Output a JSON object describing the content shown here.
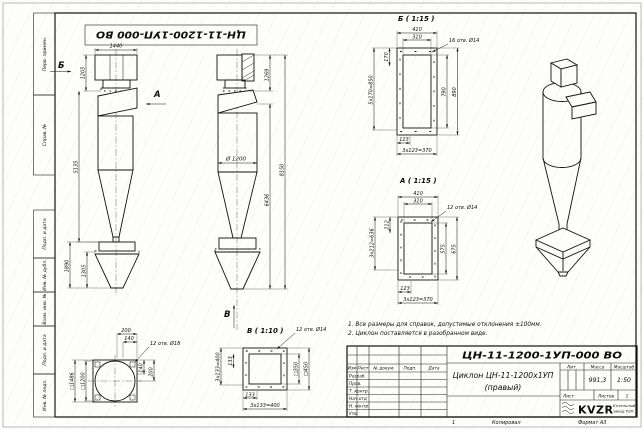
{
  "sheet": {
    "stamp_number": "ЦН-11-1200-1УП-000 ВО",
    "copied_label": "Копировал",
    "format_label": "Формат А3",
    "small_one": "1"
  },
  "frame_labels": [
    "Перв. примен.",
    "Справ. №",
    "Подп. и дата",
    "Инв. № дубл.",
    "Взам. инв. №",
    "Подп. и дата",
    "Инв. № подл."
  ],
  "notes": {
    "line1": "1. Все размеры для справок, допустимые отклонения ±100мм.",
    "line2": "2. Циклон поставляется в разобранном виде."
  },
  "front_view": {
    "label_b": "Б",
    "label_a": "А",
    "dim_1440": "1440",
    "dim_1205": "1205",
    "dim_5135": "5135",
    "dim_1890": "1890",
    "dim_1305": "1305"
  },
  "side_view": {
    "label_v": "В",
    "dim_1269": "1269",
    "dim_8150": "8150",
    "dim_6436": "6436",
    "dim_d1200": "Ø 1200"
  },
  "detail_b": {
    "title": "Б ( 1:15 )",
    "holes": "16 отв. Ø14",
    "d410": "410",
    "d310": "310",
    "d170": "170",
    "d5x170": "5х170=850",
    "d790": "790",
    "d890": "890",
    "d123": "123",
    "d3x123": "3х123=370"
  },
  "detail_a": {
    "title": "А ( 1:15 )",
    "holes": "12 отв. Ø14",
    "d410": "410",
    "d310": "310",
    "d212": "212",
    "d3x212": "3х212=636",
    "d575": "575",
    "d675": "675",
    "d123": "123",
    "d3x123": "3х123=370"
  },
  "detail_v": {
    "title": "В ( 1:10 )",
    "holes": "12 отв. Ø14",
    "d350": "□350",
    "d450": "□450",
    "d133b": "133",
    "d3x133b": "3х133=400",
    "d133l": "133",
    "d3x133l": "3х133=400"
  },
  "bottom_view": {
    "holes": "12 отв. Ø18",
    "d200t": "200",
    "d140t": "140",
    "d1486": "□1486",
    "d1200": "□1200",
    "d140r": "140",
    "d200r": "200"
  },
  "titleblock": {
    "doc_number": "ЦН-11-1200-1УП-000 ВО",
    "title_line1": "Циклон ЦН-11-1200х1УП",
    "title_line2": "(правый)",
    "cols": {
      "izm": "Изм",
      "list": "Лист",
      "doc": "№ докум.",
      "podp": "Подп.",
      "data": "Дата"
    },
    "rows": {
      "razrab": "Разраб.",
      "prov": "Пров.",
      "tkontr": "Т. контр.",
      "nachotd": "Нач.отд",
      "nkontr": "Н. контр.",
      "utv": "Утв."
    },
    "lit_label": "Лит.",
    "massa_label": "Масса",
    "masshtab_label": "Масштаб",
    "massa_value": "991,3",
    "masshtab_value": "1:50",
    "list_label": "Лист",
    "listov_label": "Листов",
    "listov_value": "1",
    "logo_text": "KVZR",
    "logo_caption_line1": "Котельный",
    "logo_caption_line2": "завод РЭП"
  }
}
